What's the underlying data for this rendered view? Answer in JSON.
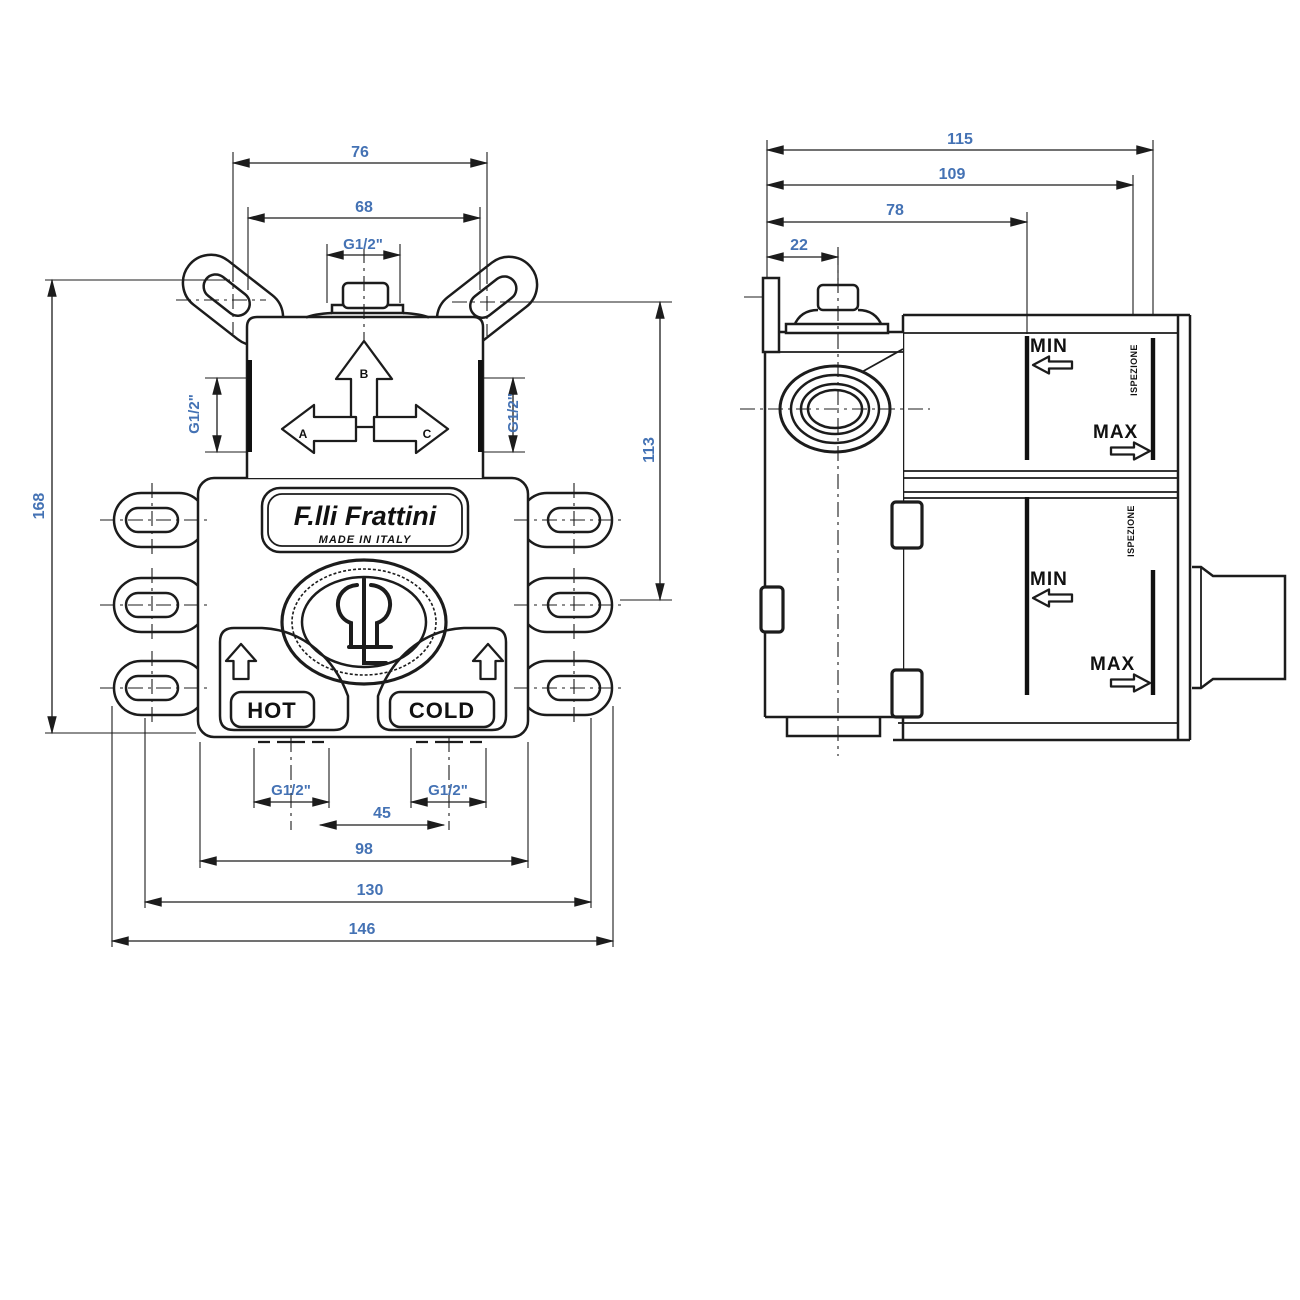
{
  "colors": {
    "line": "#1c1c1c",
    "dimension_text": "#4472b4"
  },
  "front_view": {
    "brand": "F.lli Frattini",
    "made_in": "MADE IN ITALY",
    "hot": "HOT",
    "cold": "COLD",
    "ports": {
      "a": "A",
      "b": "B",
      "c": "C"
    },
    "dims": {
      "top_outer": "76",
      "top_inner": "68",
      "top_port": "G1/2\"",
      "left_port": "G1/2\"",
      "right_port": "G1/2\"",
      "height": "168",
      "height_right": "113",
      "hot_port": "G1/2\"",
      "cold_port": "G1/2\"",
      "inlet_span": "45",
      "span_98": "98",
      "span_130": "130",
      "span_146": "146"
    }
  },
  "side_view": {
    "dims": {
      "d115": "115",
      "d109": "109",
      "d78": "78",
      "d22": "22"
    },
    "upper_section": {
      "min": "MIN",
      "max": "MAX",
      "wall_label": "ISPEZIONE"
    },
    "lower_section": {
      "min": "MIN",
      "max": "MAX",
      "wall_label": "ISPEZIONE"
    }
  }
}
